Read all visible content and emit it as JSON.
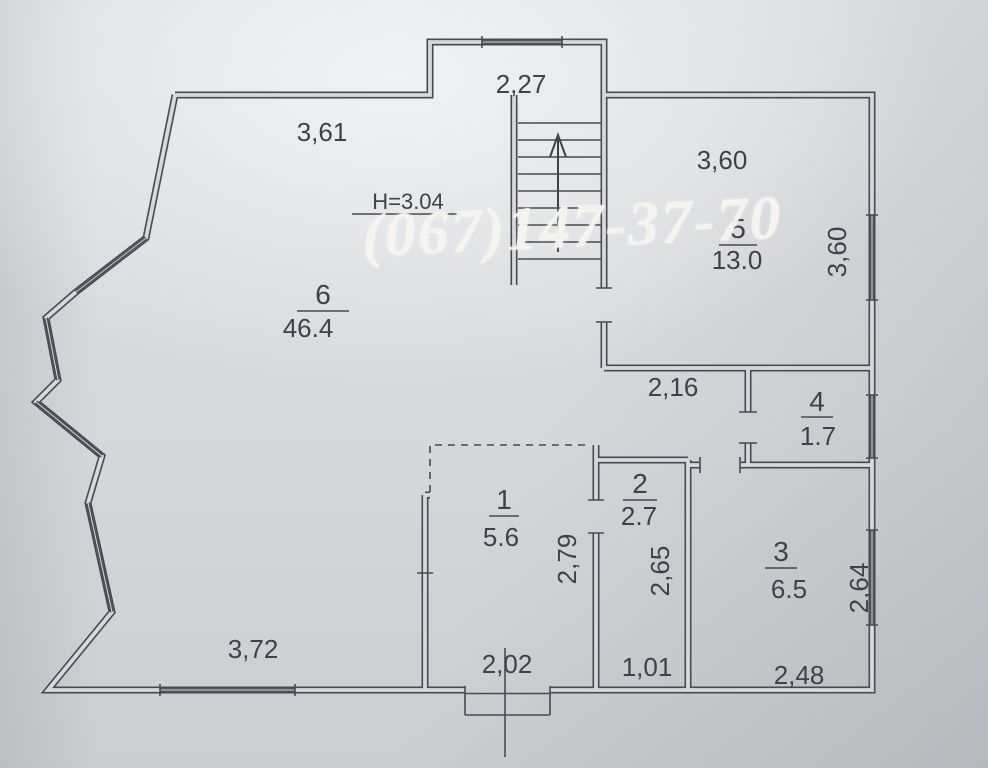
{
  "photo": {
    "paper_color": "#d8dadd",
    "line_color": "#474a4f",
    "text_color": "#3f4246",
    "watermark_color": "#f3f1ea"
  },
  "watermark": {
    "phone": "(067)147-37-70"
  },
  "plan": {
    "height_note": "H=3.04",
    "stairs": {
      "direction": "up",
      "treads": 9,
      "icon": "stairs-up-arrow"
    },
    "rooms": [
      {
        "number": "1",
        "area": "5.6"
      },
      {
        "number": "2",
        "area": "2.7"
      },
      {
        "number": "3",
        "area": "6.5"
      },
      {
        "number": "4",
        "area": "1.7"
      },
      {
        "number": "5",
        "area": "13.0"
      },
      {
        "number": "6",
        "area": "46.4"
      }
    ],
    "dimensions": {
      "top_notch_width": "2,27",
      "top_wall": "3,61",
      "room5_width": "3,60",
      "room5_depth": "3,60",
      "hall_wall": "2,16",
      "room1_width": "2,02",
      "room1_depth": "2,79",
      "room2_width": "1,01",
      "room2_depth": "2,65",
      "room3_width": "2,48",
      "room3_depth": "2,64",
      "bottom_wall": "3,72"
    }
  }
}
